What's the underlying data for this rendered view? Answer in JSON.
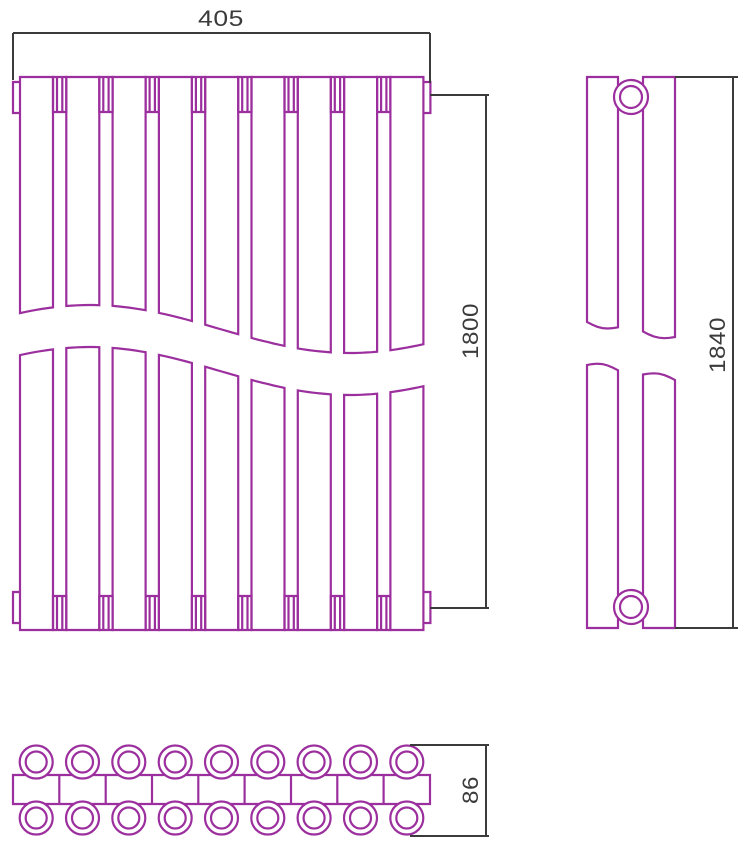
{
  "colors": {
    "linework": "#9c2f9e",
    "dimension": "#3b3b3b",
    "background": "#ffffff"
  },
  "dimensions": {
    "width": {
      "value": "405"
    },
    "height_front": {
      "value": "1800"
    },
    "height_side": {
      "value": "1840"
    },
    "depth": {
      "value": "86"
    }
  },
  "structure": {
    "front_sections": 9,
    "top_view_tubes_per_row": 9,
    "top_view_rows": 2
  }
}
